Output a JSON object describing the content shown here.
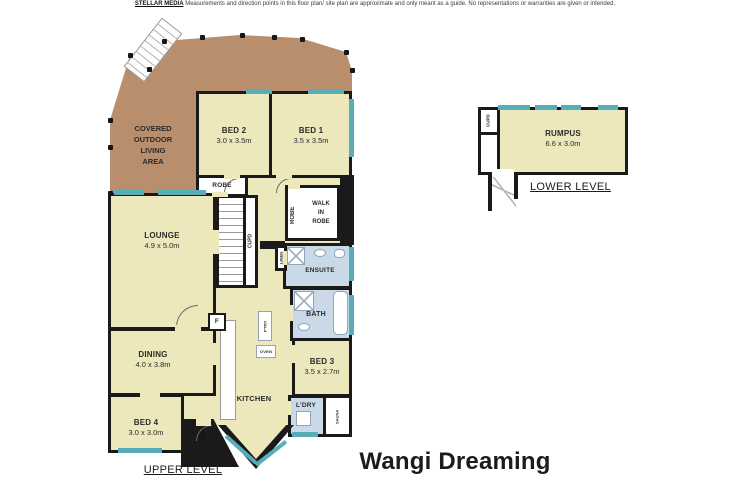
{
  "disclaimer": {
    "brand": "STELLAR MEDIA",
    "text": "Measurements and direction points in this floor plan/ site plan are approximate and only meant as a guide. No representations or warranties are given or intended."
  },
  "title": "Wangi Dreaming",
  "levels": {
    "upper": "UPPER LEVEL",
    "lower": "LOWER LEVEL"
  },
  "rooms": {
    "covered_outdoor": {
      "name": "COVERED\nOUTDOOR\nLIVING\nAREA"
    },
    "bed1": {
      "name": "BED 1",
      "dims": "3.5 x 3.5m"
    },
    "bed2": {
      "name": "BED 2",
      "dims": "3.0 x 3.5m"
    },
    "bed3": {
      "name": "BED 3",
      "dims": "3.5 x 2.7m"
    },
    "bed4": {
      "name": "BED 4",
      "dims": "3.0 x 3.0m"
    },
    "lounge": {
      "name": "LOUNGE",
      "dims": "4.9 x 5.0m"
    },
    "dining": {
      "name": "DINING",
      "dims": "4.0 x 3.8m"
    },
    "kitchen": {
      "name": "KITCHEN"
    },
    "rumpus": {
      "name": "RUMPUS",
      "dims": "6.6 x 3.0m"
    },
    "ensuite": {
      "name": "ENSUITE"
    },
    "bath": {
      "name": "BATH"
    },
    "laundry": {
      "name": "L'DRY"
    },
    "sauna": {
      "name": "SAUNA"
    },
    "robe": {
      "name": "ROBE"
    },
    "walk_in_robe": {
      "name": "WALK\nIN\nROBE"
    },
    "robe_vertical": {
      "name": "ROBE"
    },
    "cupboard_upper": {
      "name": "CUPD"
    },
    "cupboard_lower": {
      "name": "CUPD"
    },
    "linen": {
      "name": "LINEN"
    },
    "pantry": {
      "name": "P'TRY"
    },
    "oven": {
      "name": "OVEN"
    },
    "fridge": {
      "name": "F"
    }
  },
  "colors": {
    "room_fill": "#ece8bb",
    "deck": "#b98e6c",
    "wet_area": "#c9d9e8",
    "window": "#57adb8",
    "wall": "#1a1a1a"
  }
}
